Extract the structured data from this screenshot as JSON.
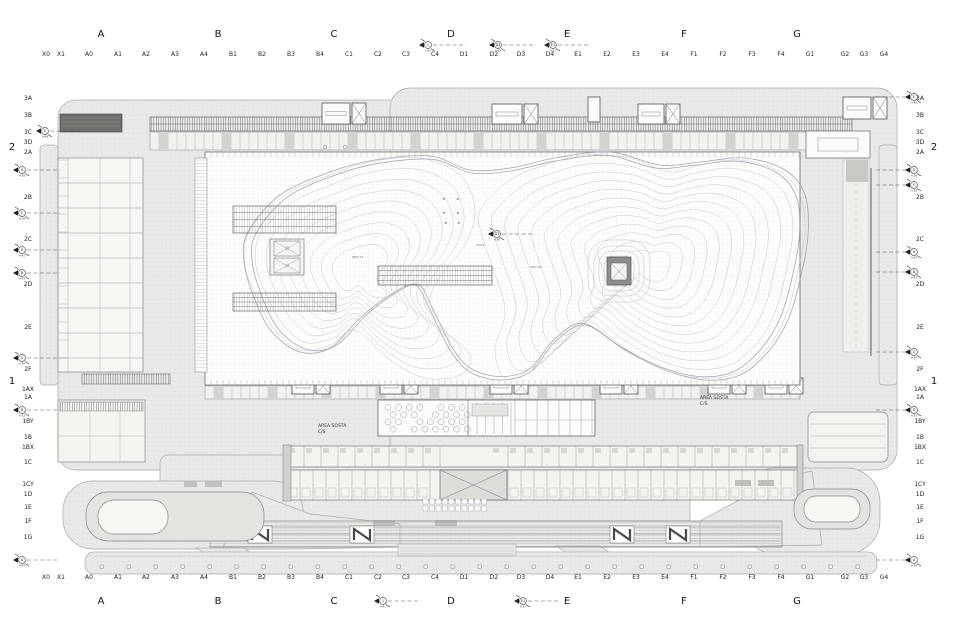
{
  "plan": {
    "area_labels": [
      {
        "line1": "AREA SOSTA",
        "line2": "C/S"
      },
      {
        "line1": "AREA SOSTA",
        "line2": "C/S"
      }
    ],
    "tiny_labels": [
      "W07.12",
      "W07.10",
      "124.4"
    ]
  },
  "grid": {
    "top_major": [
      "A",
      "B",
      "C",
      "D",
      "E",
      "F",
      "G"
    ],
    "bottom_major": [
      "A",
      "B",
      "C",
      "D",
      "E",
      "F",
      "G"
    ],
    "top_minor": [
      "X0",
      "X1",
      "A0",
      "A1",
      "A2",
      "A3",
      "A4",
      "B1",
      "B2",
      "B3",
      "B4",
      "C1",
      "C2",
      "C3",
      "C4",
      "D1",
      "D2",
      "D3",
      "D4",
      "E1",
      "E2",
      "E3",
      "E4",
      "F1",
      "F2",
      "F3",
      "F4",
      "G1",
      "G2",
      "G3",
      "G4"
    ],
    "bottom_minor": [
      "X0",
      "X1",
      "A0",
      "A1",
      "A2",
      "A3",
      "A4",
      "B1",
      "B2",
      "B3",
      "B4",
      "C1",
      "C2",
      "C3",
      "C4",
      "D1",
      "D2",
      "D3",
      "D4",
      "E1",
      "E2",
      "E3",
      "E4",
      "F1",
      "F2",
      "F3",
      "F4",
      "G1",
      "G2",
      "G3",
      "G4"
    ],
    "left_major": [
      "2",
      "1"
    ],
    "right_major": [
      "2",
      "1"
    ],
    "left_minor": [
      "3A",
      "3B",
      "3C",
      "3D",
      "2A",
      "2B",
      "2C",
      "2D",
      "2E",
      "2F",
      "1AX",
      "1A",
      "1BY",
      "1B",
      "1BX",
      "1C",
      "1CY",
      "1D",
      "1E",
      "1F",
      "1G"
    ],
    "right_minor": [
      "3A",
      "3B",
      "3C",
      "3D",
      "2A",
      "2B",
      "2C",
      "2D",
      "2E",
      "2F",
      "1AX",
      "1A",
      "1BY",
      "1B",
      "1BX",
      "1C",
      "1CY",
      "1D",
      "1E",
      "1F",
      "1G"
    ]
  },
  "markers": {
    "left": [
      {
        "label": "E",
        "ref": "A-48"
      },
      {
        "label": "G",
        "ref": "A-38"
      },
      {
        "label": "F",
        "ref": "A-39"
      },
      {
        "label": "H",
        "ref": "A-42"
      },
      {
        "label": "B",
        "ref": "A-43"
      },
      {
        "label": "C",
        "ref": "A-34"
      },
      {
        "label": "D",
        "ref": "A-33"
      },
      {
        "label": "A",
        "ref": "A-44"
      }
    ],
    "right": [
      {
        "label": "E",
        "ref": "A-48"
      },
      {
        "label": "G",
        "ref": "A-38"
      },
      {
        "label": "F",
        "ref": "A-39"
      },
      {
        "label": "H",
        "ref": "A-42"
      },
      {
        "label": "B",
        "ref": "A-43"
      },
      {
        "label": "C",
        "ref": "A-34"
      },
      {
        "label": "D",
        "ref": "A-33"
      },
      {
        "label": "A",
        "ref": "A-44"
      }
    ],
    "top": [
      {
        "label": "1",
        "ref": "A-41"
      },
      {
        "label": "D3",
        "ref": "A-38"
      },
      {
        "label": "E1",
        "ref": "A-37"
      }
    ],
    "bottom": [
      {
        "label": "1",
        "ref": "A-41"
      },
      {
        "label": "E1",
        "ref": "A-37"
      }
    ],
    "plan": [
      {
        "label": "D3",
        "ref": "A-38"
      }
    ]
  },
  "colors": {
    "ink": "#444444",
    "mass": "#e9e9e7",
    "mass_stroke": "#a8a8a5",
    "dark_band": "#6f6f6c",
    "contour": "#bcbdc6",
    "road": "#d9d9d6",
    "hall": "#fdfdfc"
  }
}
